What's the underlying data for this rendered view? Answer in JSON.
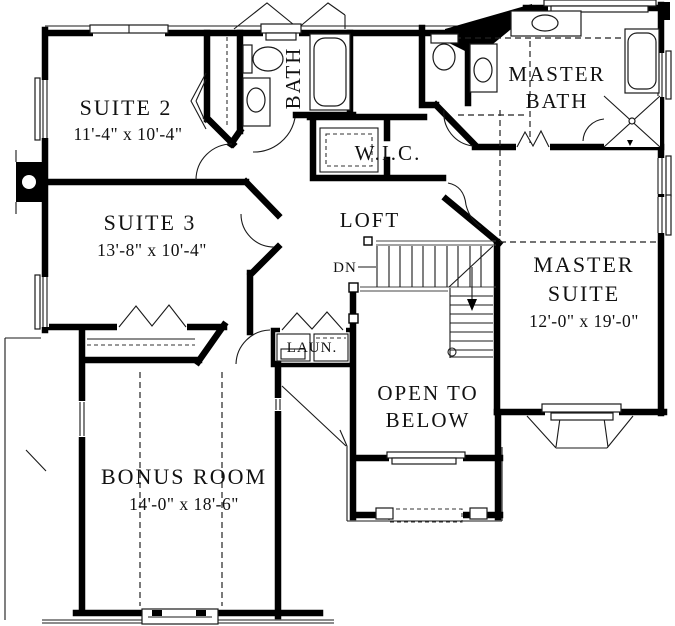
{
  "plan": {
    "suite2": {
      "name": "SUITE 2",
      "dims": "11'-4\" x 10'-4\""
    },
    "suite3": {
      "name": "SUITE 3",
      "dims": "13'-8\" x 10'-4\""
    },
    "bath": {
      "name": "BATH"
    },
    "wic": {
      "name": "W.I.C."
    },
    "master_bath": {
      "line1": "MASTER",
      "line2": "BATH"
    },
    "master_suite": {
      "line1": "MASTER",
      "line2": "SUITE",
      "dims": "12'-0\" x 19'-0\""
    },
    "loft": {
      "name": "LOFT"
    },
    "stairs": {
      "label": "DN"
    },
    "laundry": {
      "name": "LAUN."
    },
    "open_below": {
      "line1": "OPEN TO",
      "line2": "BELOW"
    },
    "bonus": {
      "name": "BONUS ROOM",
      "dims": "14'-0\" x 18'-6\""
    }
  },
  "colors": {
    "ink": "#000000",
    "paper": "#ffffff"
  }
}
